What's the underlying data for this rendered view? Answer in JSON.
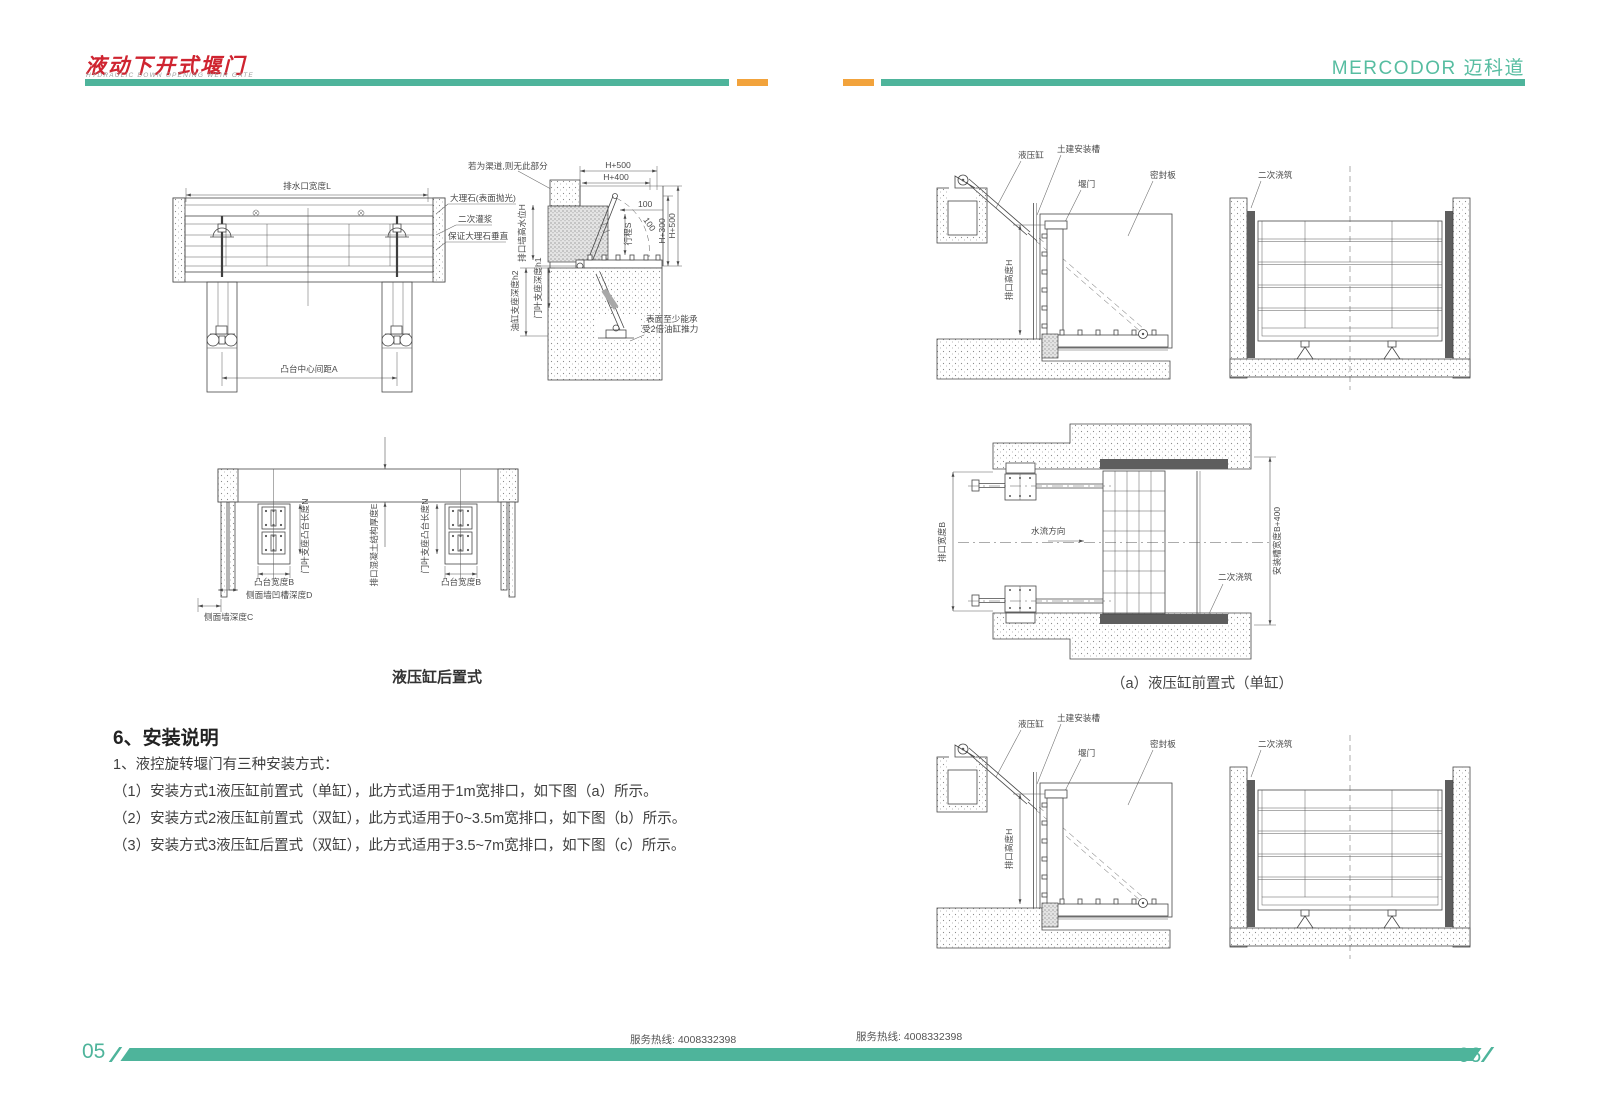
{
  "header": {
    "logo_title": "液动下开式堰门",
    "logo_subtitle": "HYDRAULIC DOWN OPENING WEIR GATE",
    "brand": "MERCODOR 迈科道"
  },
  "left_page": {
    "front_view": {
      "dim_width": "排水口宽度L",
      "dim_spacing": "凸台中心间距A"
    },
    "side_view": {
      "note_channel": "若为渠道,则无此部分",
      "label_marble": "大理石(表面抛光)",
      "label_grout": "二次灌浆",
      "label_vertical": "保证大理石垂直",
      "dim_h500_top": "H+500",
      "dim_h400": "H+400",
      "dim_100": "100",
      "dim_100_diag": "100",
      "dim_stroke": "行程S",
      "dim_h300": "H+300",
      "dim_h500_right": "H+500",
      "v_label_height": "排口墙高水位H",
      "v_label_cyl_depth": "油缸支座深度h2",
      "v_label_gate_depth": "门叶支座深度h1",
      "note_force_1": "表面至少能承",
      "note_force_2": "受2倍油缸推力"
    },
    "plan_view": {
      "v_label_boss_len": "门叶支座凸台长度N",
      "v_label_concrete": "排口混凝土结构厚度E",
      "label_boss_width": "凸台宽度B",
      "label_groove_depth": "侧面墙凹槽深度D",
      "label_wall_depth": "侧面墙深度C"
    },
    "caption": "液压缸后置式",
    "section": {
      "heading": "6、安装说明",
      "intro": "1、液控旋转堰门有三种安装方式：",
      "items": [
        "（1）安装方式1液压缸前置式（单缸），此方式适用于1m宽排口，如下图（a）所示。",
        "（2）安装方式2液压缸前置式（双缸），此方式适用于0~3.5m宽排口，如下图（b）所示。",
        "（3）安装方式3液压缸后置式（双缸），此方式适用于3.5~7m宽排口，如下图（c）所示。"
      ]
    },
    "footer": {
      "page_no": "05",
      "hotline": "服务热线: 4008332398"
    }
  },
  "right_page": {
    "install_view": {
      "label_cylinder": "液压缸",
      "label_groove": "土建安装槽",
      "label_gate": "堰门",
      "label_seal": "密封板",
      "label_pour": "二次浇筑",
      "v_label_height": "排口高度H"
    },
    "plan_view": {
      "v_label_width": "排口宽度B",
      "label_flow": "水流方向",
      "label_pour": "二次浇筑",
      "v_label_groove": "安装槽宽度B+400"
    },
    "caption_a": "（a）液压缸前置式（单缸）",
    "footer": {
      "page_no": "06",
      "hotline": "服务热线: 4008332398"
    }
  },
  "colors": {
    "teal": "#4eb49b",
    "orange": "#f2a33c",
    "logo_red": "#cf2430",
    "line": "#474747"
  }
}
